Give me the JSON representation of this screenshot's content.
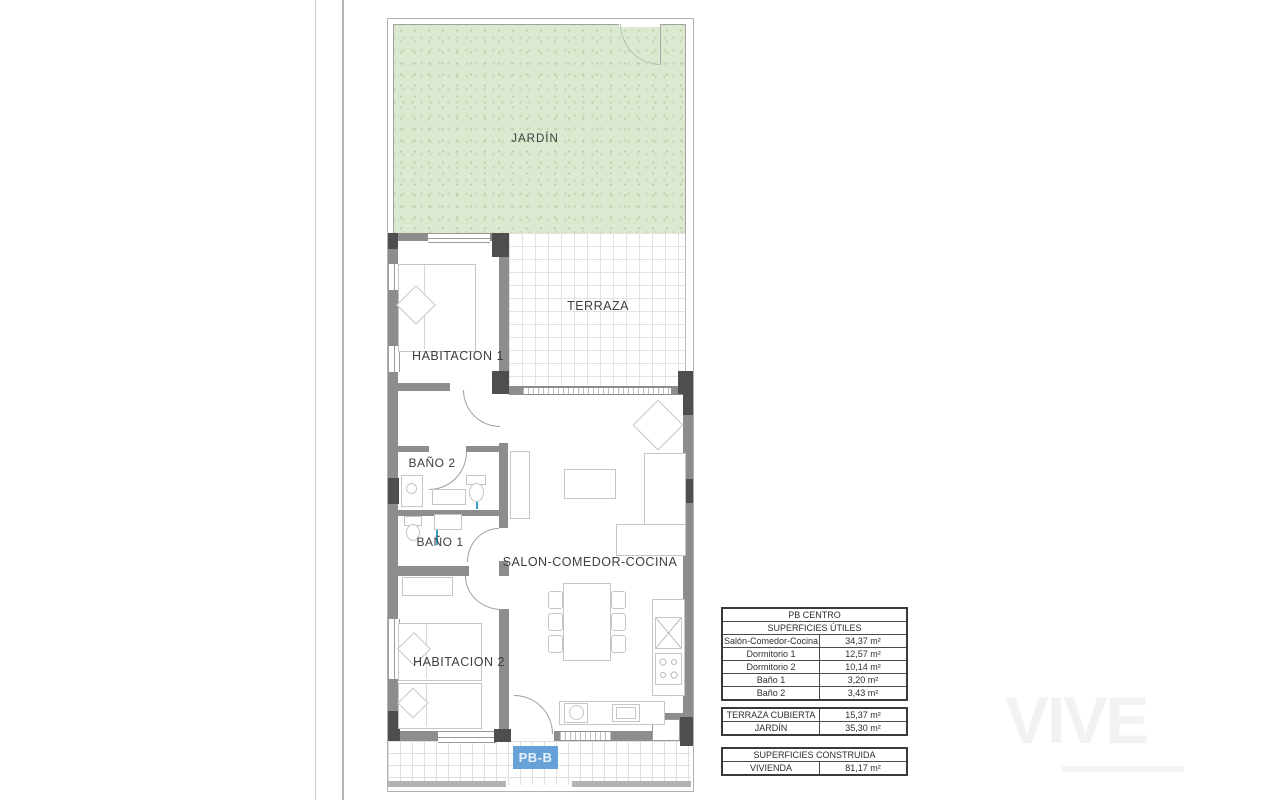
{
  "plan": {
    "sheet_label": "PB-B",
    "rooms": {
      "jardin": "JARDÍN",
      "terraza": "TERRAZA",
      "habitacion1": "HABITACION 1",
      "habitacion2": "HABITACION 2",
      "bano2": "BAÑO 2",
      "bano1": "BAÑO 1",
      "salon": "SALON-COMEDOR-COCINA"
    },
    "colors": {
      "garden_fill": "#dbe9d1",
      "wall": "#8d8d8d",
      "pillar": "#4e4e4e",
      "plumbing": "#36a0c9",
      "sheet_label_bg": "#66a1d7"
    }
  },
  "tables": {
    "useful": {
      "title": "PB CENTRO",
      "subtitle": "SUPERFICIES ÚTILES",
      "rows": [
        {
          "label": "Salón-Comedor-Cocina",
          "value": "34,37 m²"
        },
        {
          "label": "Dormitorio 1",
          "value": "12,57 m²"
        },
        {
          "label": "Dormitorio 2",
          "value": "10,14 m²"
        },
        {
          "label": "Baño 1",
          "value": "3,20 m²"
        },
        {
          "label": "Baño 2",
          "value": "3,43 m²"
        }
      ]
    },
    "exterior": {
      "rows": [
        {
          "label": "TERRAZA CUBIERTA",
          "value": "15,37 m²"
        },
        {
          "label": "JARDÍN",
          "value": "35,30 m²"
        }
      ]
    },
    "built": {
      "title": "SUPERFICIES CONSTRUIDA",
      "rows": [
        {
          "label": "VIVIENDA",
          "value": "81,17 m²"
        }
      ]
    }
  },
  "watermark": {
    "logo": "VIVE"
  }
}
